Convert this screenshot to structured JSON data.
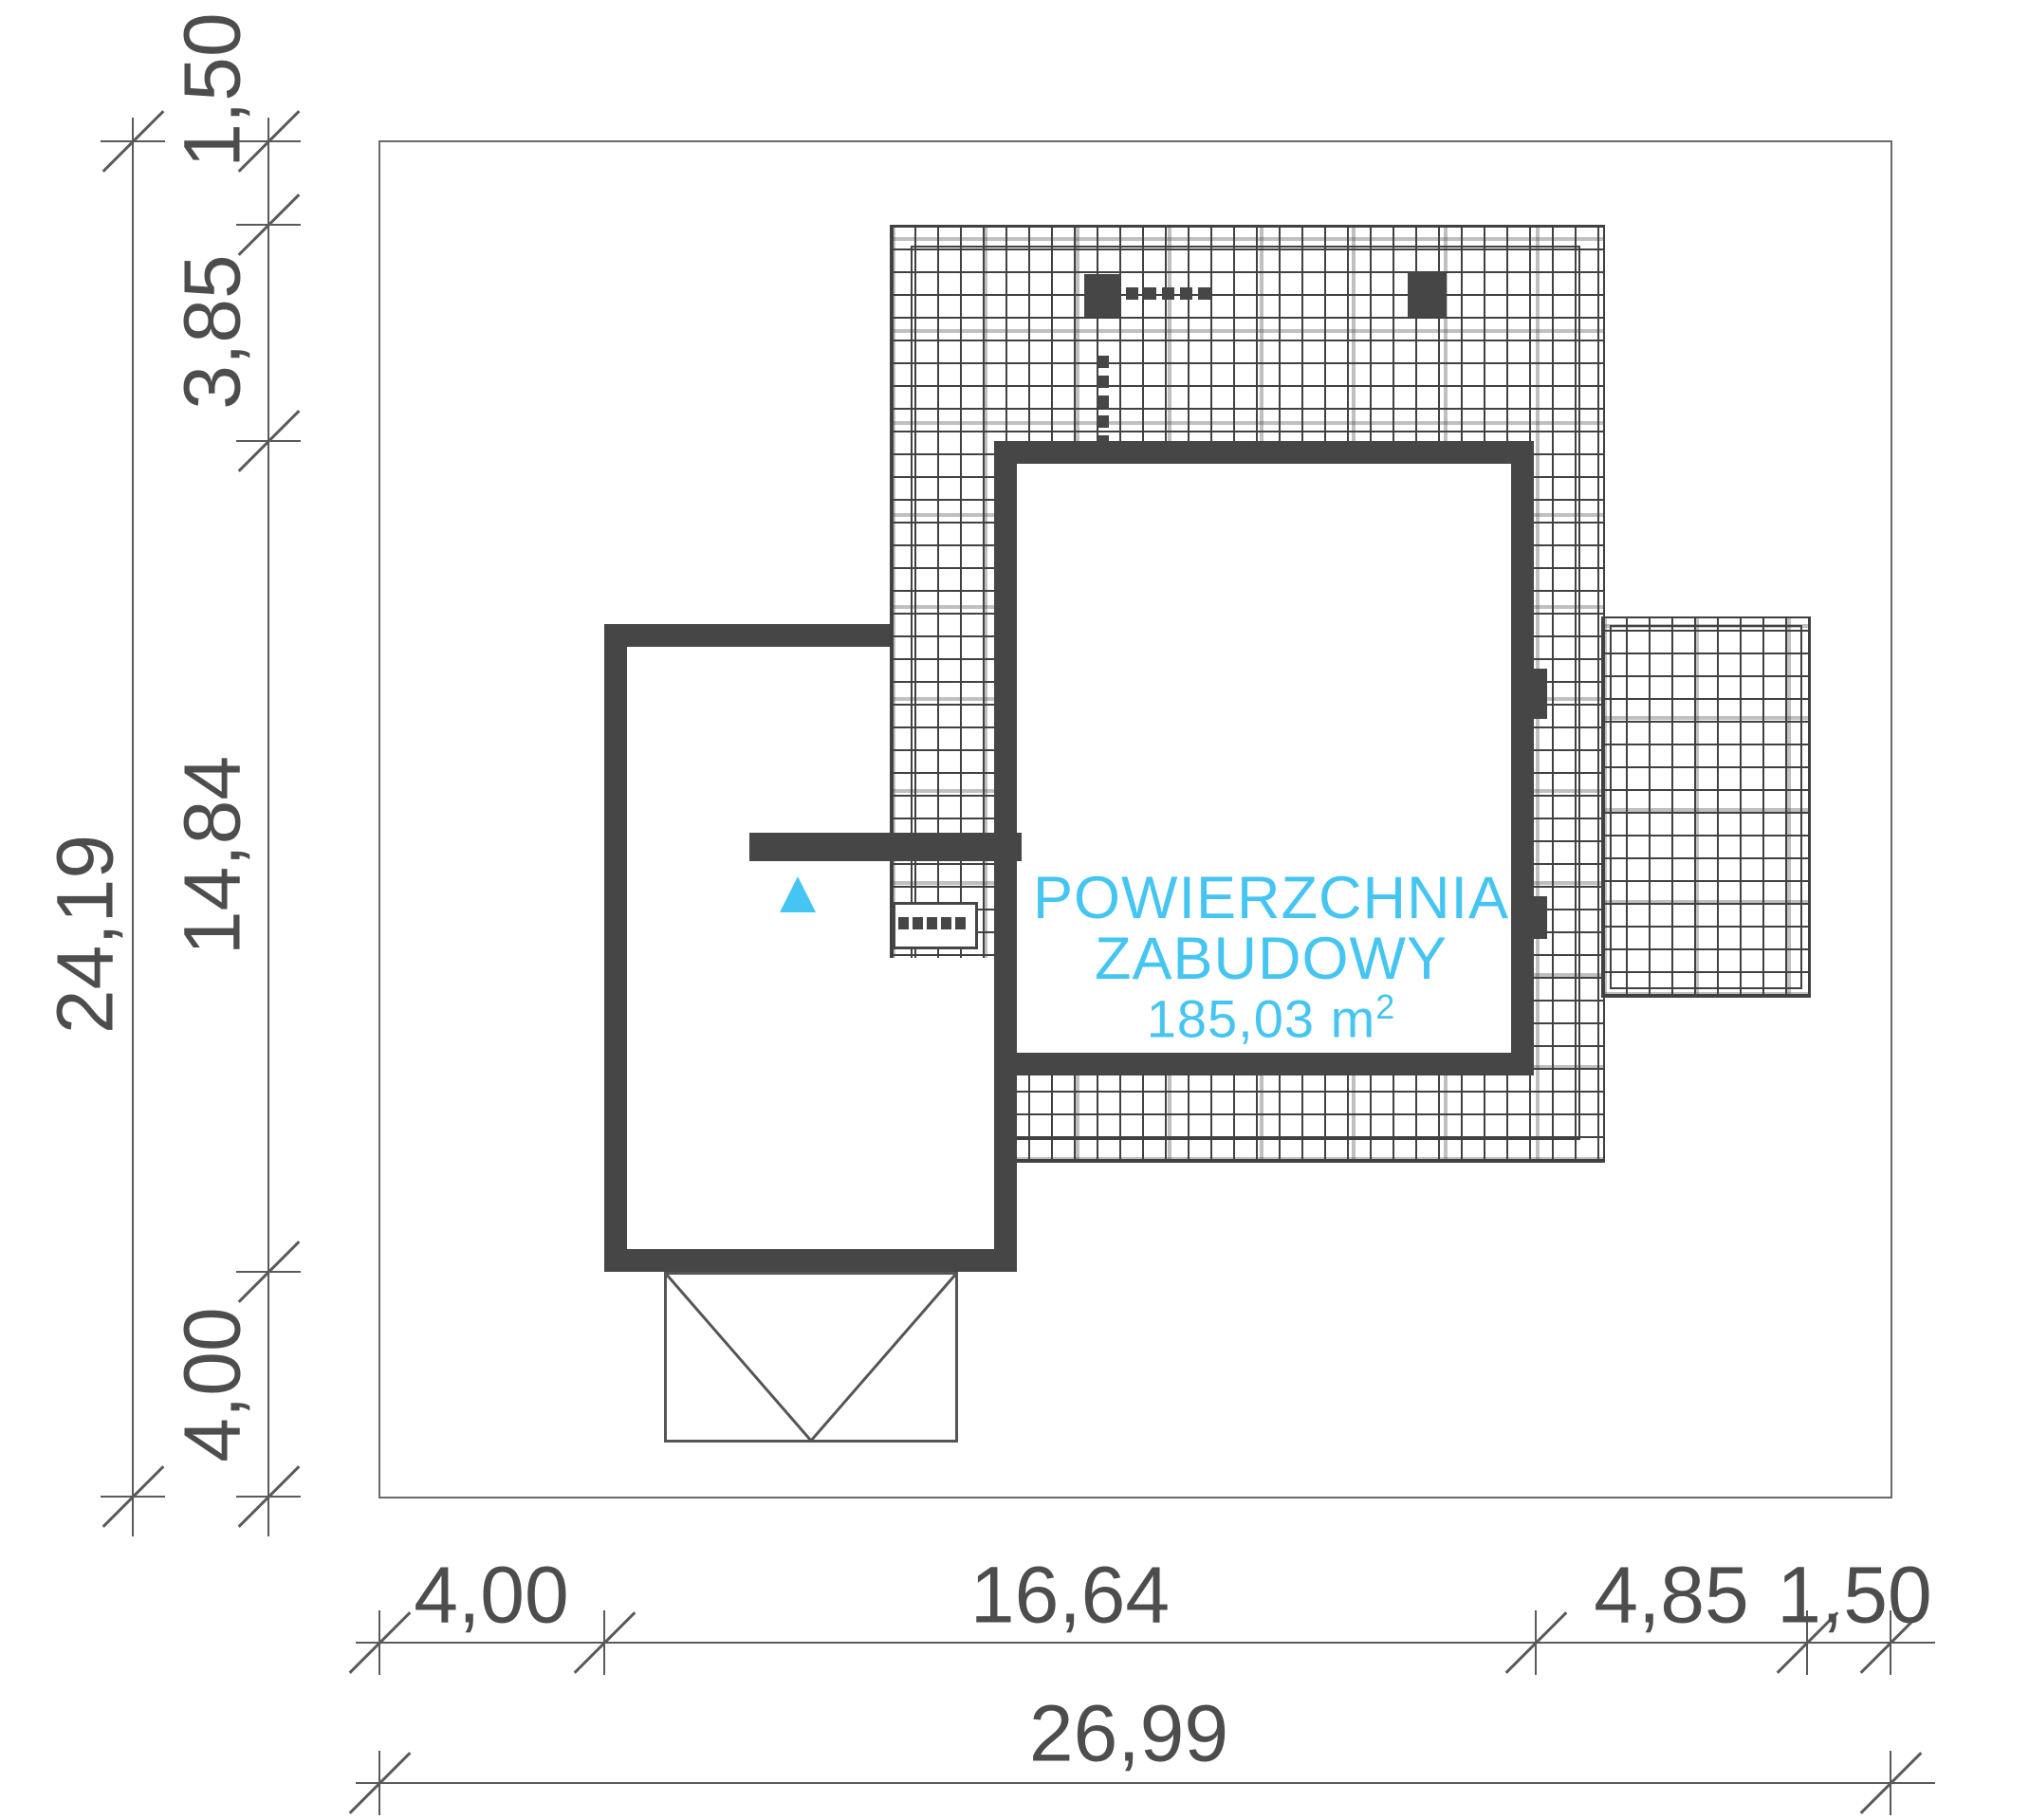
{
  "drawing": {
    "area_label": {
      "line1": "POWIERZCHNIA",
      "line2": "ZABUDOWY",
      "area_value": "185,03 m",
      "area_exponent": "2"
    },
    "dimensions": {
      "vertical": {
        "total": "24,19",
        "segments": [
          "1,50",
          "3,85",
          "14,84",
          "4,00"
        ]
      },
      "horizontal": {
        "segments": [
          "4,00",
          "16,64",
          "4,85",
          "1,50"
        ],
        "total": "26,99"
      }
    },
    "colors": {
      "wall": "#464646",
      "hatch_line": "#414141",
      "dimension": "#4d4d4d",
      "accent": "#45c5f1",
      "background": "#ffffff"
    }
  }
}
